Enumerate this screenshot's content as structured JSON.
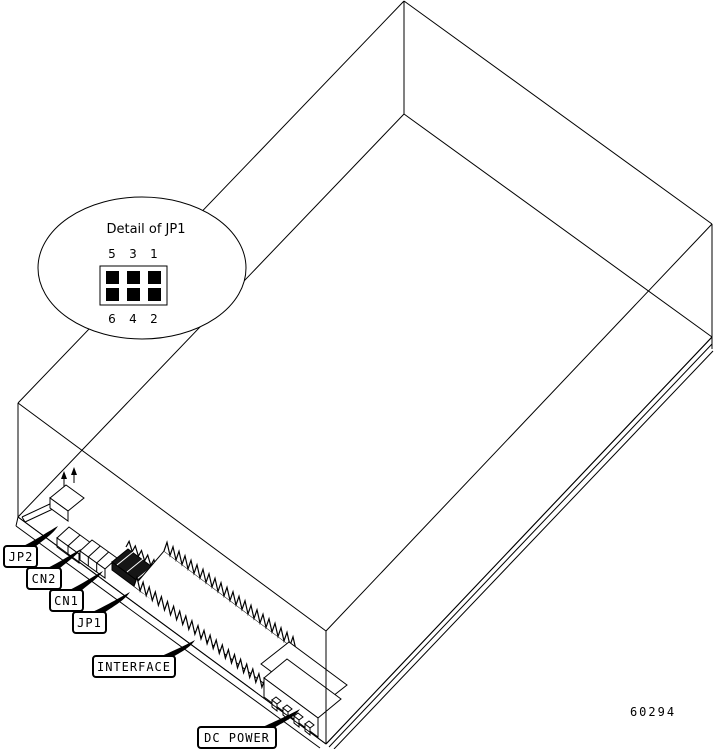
{
  "figure": {
    "part_number": "60294",
    "detail_callout": {
      "title": "Detail of JP1",
      "pins_top": [
        "5",
        "3",
        "1"
      ],
      "pins_bottom": [
        "6",
        "4",
        "2"
      ]
    },
    "callouts": [
      {
        "id": "jp2",
        "label": "JP2"
      },
      {
        "id": "cn2",
        "label": "CN2"
      },
      {
        "id": "cn1",
        "label": "CN1"
      },
      {
        "id": "jp1",
        "label": "JP1"
      },
      {
        "id": "interface",
        "label": "INTERFACE"
      },
      {
        "id": "dc-power",
        "label": "DC POWER"
      }
    ],
    "colors": {
      "background": "#ffffff",
      "line": "#000000"
    }
  }
}
